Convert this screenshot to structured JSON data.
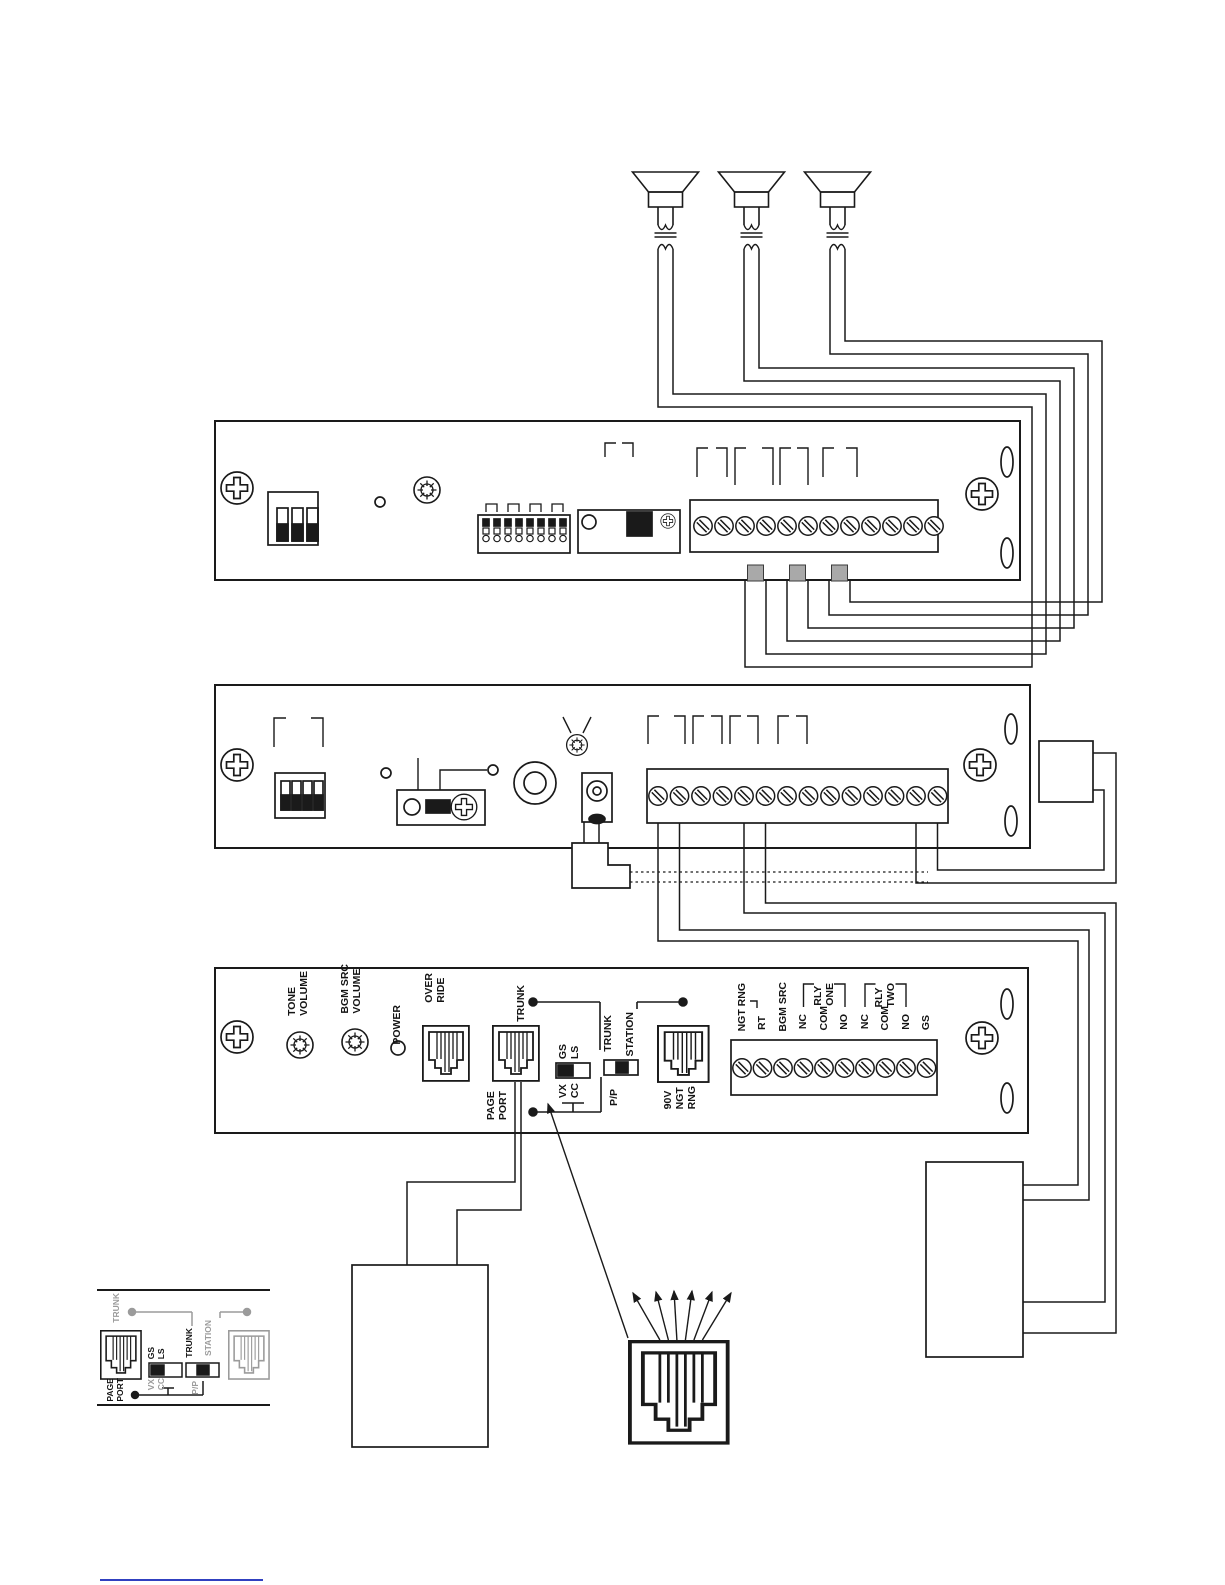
{
  "colors": {
    "ink": "#1a1a1a",
    "gray": "#9b9b9b",
    "square_fill": "#a9a9a9",
    "link_line": "#3040c0",
    "paper": "#ffffff"
  },
  "bottom_panel": {
    "tone_volume": "TONE\nVOLUME",
    "bgm_src_volume": "BGM SRC\nVOLUME",
    "power": "POWER",
    "over_ride": "OVER\nRIDE",
    "trunk_upper": "TRUNK",
    "page_port": "PAGE\nPORT",
    "gs_ls": "GS\nLS",
    "vx_cc": "VX\nCC",
    "trunk_switch": "TRUNK",
    "station": "STATION",
    "pp": "P/P",
    "ngt_jack": "90V\nNGT\nRNG",
    "terminals": [
      "NGT RNG",
      "RT",
      "BGM SRC",
      "NC",
      "COM",
      "NO",
      "NC",
      "COM",
      "NO",
      "GS"
    ],
    "rly_one": "RLY\nONE",
    "rly_two": "RLY\nTWO"
  },
  "inset": {
    "trunk_line": "TRUNK",
    "page_port": "PAGE\nPORT",
    "gs_ls": "GS\nLS",
    "vx_cc": "VX\nCC",
    "trunk_switch": "TRUNK",
    "station": "STATION",
    "pp": "P/P"
  }
}
